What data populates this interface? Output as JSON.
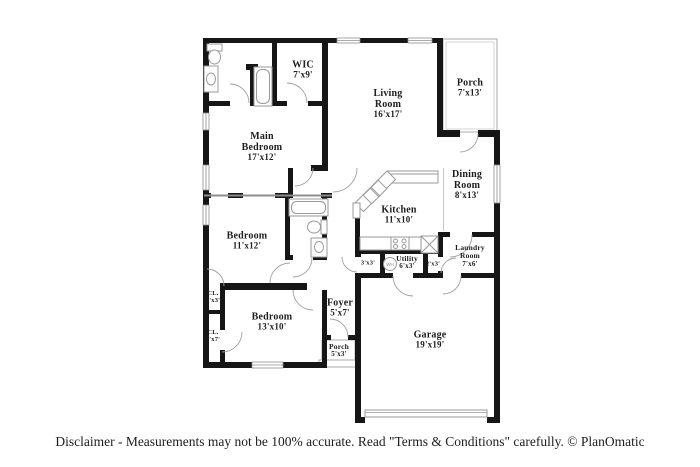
{
  "disclaimer": "Disclaimer - Measurements may not be 100% accurate. Read \"Terms & Conditions\" carefully. © PlanOmatic",
  "fixtures": {
    "water_heater_label": "WH"
  },
  "colors": {
    "wall": "#161616",
    "thin_line": "#9a9a9a",
    "text": "#1d1d1d"
  },
  "rooms": [
    {
      "id": "wic",
      "lines": [
        "WIC"
      ],
      "dims": "7'x9'",
      "x": 303,
      "y": 70,
      "size": "md"
    },
    {
      "id": "living-room",
      "lines": [
        "Living",
        "Room"
      ],
      "dims": "16'x17'",
      "x": 388,
      "y": 104,
      "size": "md"
    },
    {
      "id": "porch-top",
      "lines": [
        "Porch"
      ],
      "dims": "7'x13'",
      "x": 470,
      "y": 88,
      "size": "md"
    },
    {
      "id": "main-bedroom",
      "lines": [
        "Main",
        "Bedroom"
      ],
      "dims": "17'x12'",
      "x": 262,
      "y": 147,
      "size": "md"
    },
    {
      "id": "dining-room",
      "lines": [
        "Dining",
        "Room"
      ],
      "dims": "8'x13'",
      "x": 467,
      "y": 185,
      "size": "md"
    },
    {
      "id": "kitchen",
      "lines": [
        "Kitchen"
      ],
      "dims": "11'x10'",
      "x": 399,
      "y": 215,
      "size": "md"
    },
    {
      "id": "bedroom-2",
      "lines": [
        "Bedroom"
      ],
      "dims": "11'x12'",
      "x": 247,
      "y": 241,
      "size": "md"
    },
    {
      "id": "laundry-room",
      "lines": [
        "Laundry",
        "Room"
      ],
      "dims": "7'x6'",
      "x": 470,
      "y": 256,
      "size": "sm"
    },
    {
      "id": "utility",
      "lines": [
        "Utility"
      ],
      "dims": "6'x3'",
      "x": 407,
      "y": 263,
      "size": "sm"
    },
    {
      "id": "closet-hall",
      "lines": [],
      "dims": "3'x3'",
      "x": 368,
      "y": 263,
      "size": "xs"
    },
    {
      "id": "closet-2x3",
      "lines": [],
      "dims": "2'x3'",
      "x": 433,
      "y": 264,
      "size": "xs"
    },
    {
      "id": "foyer",
      "lines": [
        "Foyer"
      ],
      "dims": "5'x7'",
      "x": 340,
      "y": 308,
      "size": "md"
    },
    {
      "id": "bedroom-3",
      "lines": [
        "Bedroom"
      ],
      "dims": "13'x10'",
      "x": 272,
      "y": 322,
      "size": "md"
    },
    {
      "id": "closet-1",
      "lines": [
        "CL."
      ],
      "dims": "3'x3'",
      "x": 213,
      "y": 297,
      "size": "xs"
    },
    {
      "id": "closet-2",
      "lines": [
        "CL."
      ],
      "dims": "3'x7'",
      "x": 213,
      "y": 336,
      "size": "xs"
    },
    {
      "id": "porch-front",
      "lines": [
        "Porch"
      ],
      "dims": "5'x3'",
      "x": 339,
      "y": 351,
      "size": "sm"
    },
    {
      "id": "garage",
      "lines": [
        "Garage"
      ],
      "dims": "19'x19'",
      "x": 430,
      "y": 340,
      "size": "md"
    }
  ]
}
